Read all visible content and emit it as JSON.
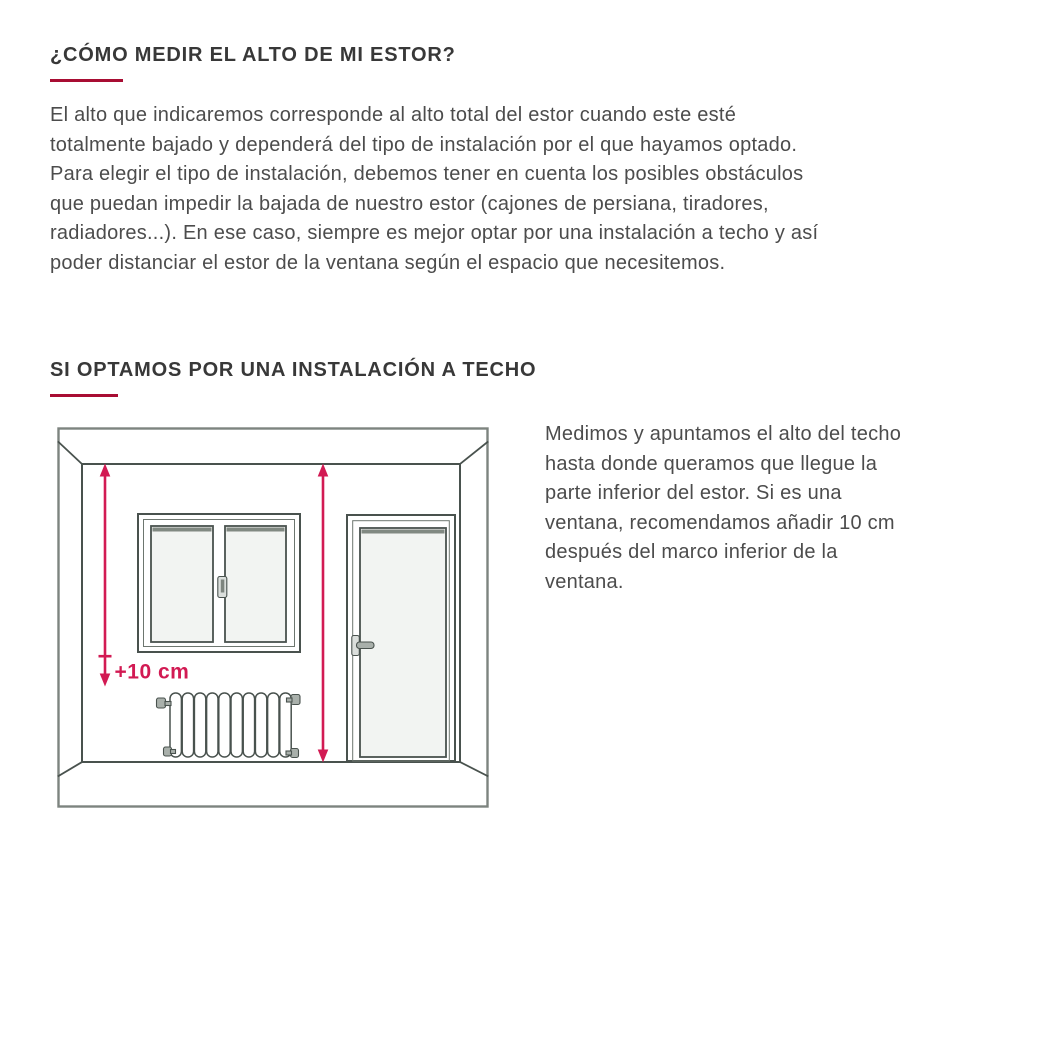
{
  "colors": {
    "accent": "#d21a53",
    "rule": "#a80d33",
    "ink": "#383838",
    "body": "#4c4c4c",
    "line": "#49524e",
    "lineOuter": "#7d847f",
    "lineSoft": "#6d766f",
    "glass": "#f2f4f2",
    "metal": "#a9b0ab"
  },
  "section1": {
    "title": "¿CÓMO MEDIR EL ALTO DE MI ESTOR?",
    "lines": [
      "El alto que indicaremos corresponde al alto total del estor cuando este esté",
      "totalmente bajado y dependerá del tipo de instalación por el que hayamos optado.",
      "Para elegir el tipo de instalación, debemos tener en cuenta los posibles obstáculos",
      "que puedan impedir la bajada de nuestro estor (cajones de persiana, tiradores,",
      "radiadores...). En ese caso, siempre es mejor optar por una instalación a techo y así",
      "poder distanciar el estor de la ventana según el espacio que necesitemos."
    ]
  },
  "section2": {
    "title": "SI OPTAMOS POR UNA INSTALACIÓN A TECHO",
    "lines": [
      "Medimos y apuntamos el alto del techo",
      "hasta donde queramos que llegue la",
      "parte inferior del estor. Si es una",
      "ventana, recomendamos añadir 10 cm",
      "después del marco inferior de la",
      "ventana."
    ]
  },
  "diagram": {
    "plus10_label": "+10 cm",
    "elements": {
      "left_arrow": "ceiling-to-below-window-measure-arrow",
      "center_arrow": "ceiling-to-floor-measure-arrow",
      "window": "double-casement-window",
      "door": "door-with-glass-panel",
      "radiator": "column-radiator"
    }
  }
}
